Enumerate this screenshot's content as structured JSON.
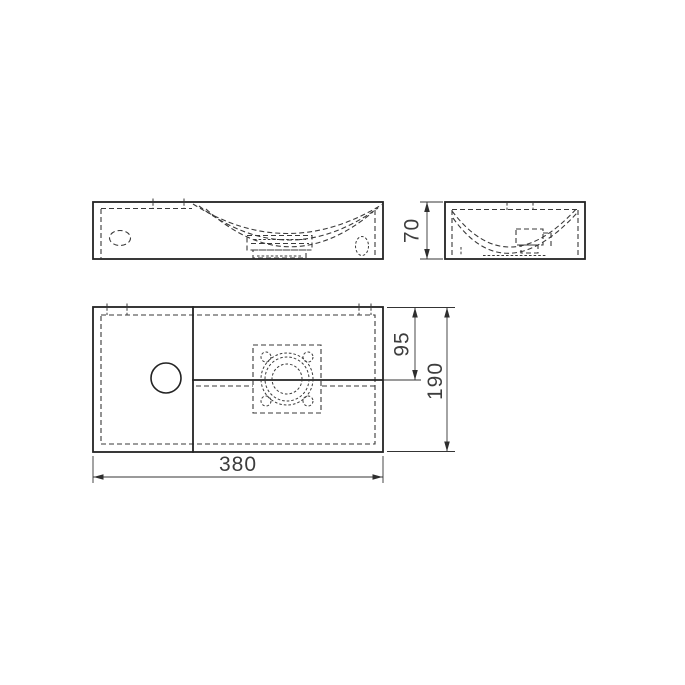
{
  "page": {
    "background": "#ffffff",
    "line_color": "#232323",
    "hidden_line_color": "#3a3a3a",
    "text_color": "#3d3d3d"
  },
  "drawing": {
    "subject": "washbasin-orthographic-technical-drawing",
    "views": [
      {
        "id": "front-elevation"
      },
      {
        "id": "side-elevation"
      },
      {
        "id": "plan-view"
      }
    ],
    "dimensions": {
      "overall_width": "380",
      "overall_depth": "190",
      "overall_height": "70",
      "bowl_centre_offset": "95"
    }
  }
}
